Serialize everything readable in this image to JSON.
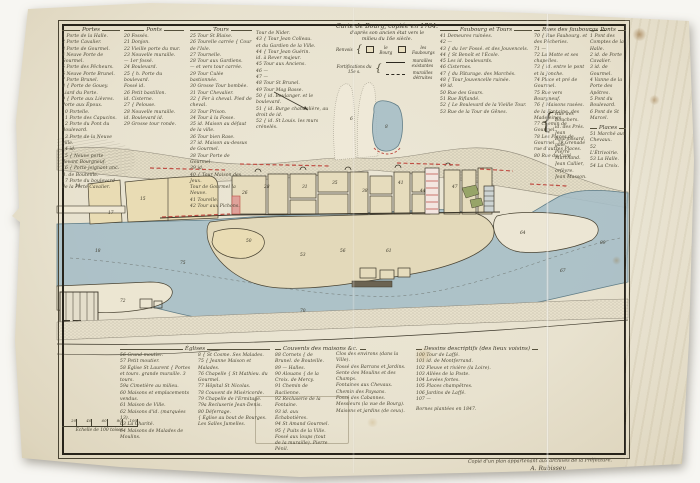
{
  "colors": {
    "water": "#a6bec6",
    "water_edge": "#607d87",
    "sand": "#e3d9ba",
    "field": "#e9dcb4",
    "town": "#e6dcbd",
    "red": "#bf4f45",
    "green": "#97a468",
    "ink": "#3c372a"
  },
  "top_legend": {
    "portes": {
      "header": "Portes",
      "items": [
        "1 Porte de la Halle.",
        "2 Porte Cavalier.",
        "3 Porte de Gourmel.",
        "4 Neuve Porte de Gourmel.",
        "5 Porte des Pêcheurs.",
        "6 Neuve Porte Brunel.",
        "7 Porte Brunel.",
        "8 { Porte de Gouey. Liard du Porte.",
        "9 { Porte aux Lièvres. Porte aux Époux.",
        "10 Portelle.",
        "11 Porte des Capucins.",
        "12 Porte du Pont du Boulevard.",
        "13 Porte de la Neuve ville.",
        "14 id.",
        "15 { Neuve porte devant Bourgneuf.",
        "16 { Porte joignant anc. B. de Bouteille.",
        "17 Porte du boulevard de la Porte Cavalier."
      ]
    },
    "ponts": {
      "header": "Ponts",
      "items": [
        "20 Fossés.",
        "21 Donjon.",
        "22 Vieille porte du mur.",
        "23 Nouvelle muraille.",
        "— 1er fossé.",
        "24 Boulevard.",
        "25 { h. Porte du boulevard.",
        "Fossé id.",
        "26 Petit bastillon.",
        "id. Cisterne.",
        "27 { Pelouse.",
        "28 Nouvelle muraille.",
        "id. Boulevard id.",
        "29 Grosse tour ronde."
      ]
    },
    "tours": {
      "header": "Tours",
      "items": [
        "25 Tour St Blaise.",
        "26 Tourelle carrée { Cour de l'Isle.",
        "27 Tournelle.",
        "28 Tour aux Gardiens.",
        "— et vers tour carrée.",
        "29 Tour Culée bastionnée.",
        "30 Grosse Tour bombée.",
        "31 Tour Chevalier.",
        "32 { Fer à cheval. Pied de cheval.",
        "33 Tour Prison.",
        "34 Tour à la Fosse.",
        "35 id. Maison au défaut de la ville.",
        "36 Tour bien Rase.",
        "37 id. Maison au-dessus de Gourmel.",
        "38 Tour Porte de Gourmel.",
        "39 id.",
        "40 { Tour Maison des Jeux.",
        "Tour de Gourmel la Neuve.",
        "41 Tourelle.",
        "42 Tour aux Pichons."
      ]
    },
    "tours2": {
      "items": [
        "Tour de Nider.",
        "43 { Tour Jean Colleau.",
        "et du Gardien de la Ville.",
        "44 { Tour Jean Guérin.",
        "id. à Rever majeur.",
        "45 Tour aux Anciens.",
        "46 —",
        "47 —",
        "48 Tour St Brunel.",
        "49 Tour Mag Basse.",
        "50 { id. Boulanger. et le boulevard.",
        "51 { id. Burge chandelière, au droit de id.",
        "52 { id. St Louis. les murs crénelés."
      ]
    },
    "faubourgs": {
      "header": "Faubourg et Tours",
      "items": [
        "41 Demeures ruinées.",
        "42 —",
        "43 { du 1er Fossé. et des Jouvencels.",
        "44 { St Benoît et l'École.",
        "45 Les id. boulevards.",
        "46 Cisternes.",
        "47 { du Pâturage. des Marchés.",
        "48 { Tour Jouvencelle ruinée.",
        "49 id.",
        "50 Rue des Gours.",
        "51 Rue Riflandé.",
        "52 { Le Boulevard de la Vieille Tour.",
        "53 Rue de la Tour de Gênes."
      ]
    },
    "rues": {
      "header": "Rues des faubourgs",
      "items": [
        "70 { Rue Faubourg. et des Pêcheries.",
        "71 —",
        "72 La Motte et ses chapelles.",
        "73 { id. entre le pont et la Jonche.",
        "74 Place et pré de Gourmel.",
        "75 Rue vers Bourgneuf.",
        "76 { Maisons rasées. de la Fontaine. des Madeleines.",
        "77 Chemin de Gourmel.",
        "78 Les Places de Gourmel. 79 Grenade rue d'autres Places.",
        "80 Rue du Curé."
      ]
    },
    "noms": {
      "items": [
        "Rue des Bouchers.",
        "id. des Prés.",
        "Jean Bournissard, gale.",
        "Pierre Marchand.",
        "Jean Callier, orfèvre.",
        "Jean Masson."
      ]
    },
    "ponts2": {
      "header": "Ponts",
      "items": [
        "1 Pont des Comptes de la Halle.",
        "2 id. de Porte Cavalier.",
        "3 id. de Gourmel.",
        "4 Vanne de la Porte des Apôtres.",
        "5 Pont du Boulevard.",
        "6 Pont de St Marcel."
      ]
    },
    "places": {
      "header": "Places",
      "items": [
        "51 Marché aux Chevaux.",
        "52 L'Étrivoirie.",
        "53 La Halle.",
        "54 La Croix."
      ]
    }
  },
  "title_block": {
    "line1": "Carte de Bourg, copiée en 1784.",
    "line2": "d'après son ancien état vers le",
    "line3": "milieu du 16e siècle.",
    "renvois_label": "Renvois",
    "renvoi_a": "le Bourg",
    "renvoi_b": "les Faubourgs",
    "fortif_label": "Fortifications du 15e s.",
    "sample1": "murailles existantes",
    "sample2": "murailles détruites"
  },
  "bottom_legend": {
    "eglises": {
      "header": "Églises",
      "col_a": [
        "56 Grand moutier.",
        "57 Petit moutier.",
        "58 Église St Laurent { Portes et tours. grande muraille. 3 tours.",
        "59a Cimetière au milieu.",
        "60 Maisons et emplacements vendus.",
        "61 Maison de Ville.",
        "62 Maisons d'id. (marquées 13).",
        "63 La Charité.",
        "64 Maisons de Malades de Moulins."
      ],
      "col_b": [
        "8 { St Cosme. Ses Malades.",
        "75 { Jeanne Maison et Malades.",
        "76 Chapelle { St Mathieu. du Gourmel.",
        "77 Hôpital St Nicolas.",
        "78 Couvent de Miséricorde.",
        "79 Chapelle de l'Ermitage.",
        "79a Recluserie Jean-Denis.",
        "80 Déferrage.",
        "{ Église au bout de Bourges. Les Salles Jumelles."
      ]
    },
    "couvents": {
      "header": "Couvents des maisons &c.",
      "col_a": [
        "88 Cornets { de Brunel. de Bouteille.",
        "89 — Halles.",
        "90 Alouans { de la Croix. de Mercy.",
        "91 Chemin de Raclienne.",
        "92 Recluserie de la Fontaine.",
        "93 id. aux Échabotières.",
        "94 St Amand Gourmel.",
        "95 { Puits de la Ville. Fossé aux loups (tout de la muraille). Pierre Pénil."
      ],
      "col_b": [
        "Clos des environs (dans la Ville).",
        "Fossé des Barrans et Jardins.",
        "Sente des Moulins et des Champs.",
        "Fontaines aux Chevaux.",
        "Chemin des Paysans.",
        "Fossé des Cabannes.",
        "Messieurs (la vue de Bourg).",
        "Maisons et jardins (de ceux)."
      ]
    },
    "bureau": {
      "header": "Dessins descriptifs (des lieux voisins)",
      "items": [
        "100 Tour de Laffé.",
        "101 id. de Montferrand.",
        "102 Fleuve et rivière (la Loire).",
        "103 Allées de la Poste.",
        "104 Levées fortes.",
        "105 Places champêtres.",
        "106 Jardins de Laffé.",
        "107 —"
      ],
      "note": "Bornes plantées en 1847."
    }
  },
  "scale_bar": {
    "label": "Échelle de 100 toises.",
    "ticks": [
      "20",
      "40",
      "60",
      "80",
      "100"
    ]
  },
  "signature": {
    "line1": "Copié d'un plan appartenant aux archives de la Préfecture.",
    "line2": "A. Rubissey"
  },
  "map": {
    "labels": [
      {
        "t": "14",
        "x": 75,
        "y": 185
      },
      {
        "t": "15",
        "x": 140,
        "y": 198
      },
      {
        "t": "17",
        "x": 108,
        "y": 212
      },
      {
        "t": "26",
        "x": 242,
        "y": 192
      },
      {
        "t": "28",
        "x": 264,
        "y": 186
      },
      {
        "t": "31",
        "x": 302,
        "y": 186
      },
      {
        "t": "35",
        "x": 332,
        "y": 182
      },
      {
        "t": "38",
        "x": 362,
        "y": 190
      },
      {
        "t": "41",
        "x": 398,
        "y": 182
      },
      {
        "t": "44",
        "x": 420,
        "y": 190
      },
      {
        "t": "47",
        "x": 452,
        "y": 186
      },
      {
        "t": "50",
        "x": 246,
        "y": 240
      },
      {
        "t": "53",
        "x": 300,
        "y": 254
      },
      {
        "t": "56",
        "x": 340,
        "y": 250
      },
      {
        "t": "61",
        "x": 386,
        "y": 250
      },
      {
        "t": "64",
        "x": 520,
        "y": 232
      },
      {
        "t": "67",
        "x": 560,
        "y": 270
      },
      {
        "t": "70",
        "x": 300,
        "y": 310
      },
      {
        "t": "72",
        "x": 120,
        "y": 300
      },
      {
        "t": "75",
        "x": 180,
        "y": 262
      },
      {
        "t": "18",
        "x": 95,
        "y": 250
      },
      {
        "t": "8",
        "x": 385,
        "y": 126
      },
      {
        "t": "6",
        "x": 350,
        "y": 118
      },
      {
        "t": "89",
        "x": 600,
        "y": 242
      }
    ]
  }
}
